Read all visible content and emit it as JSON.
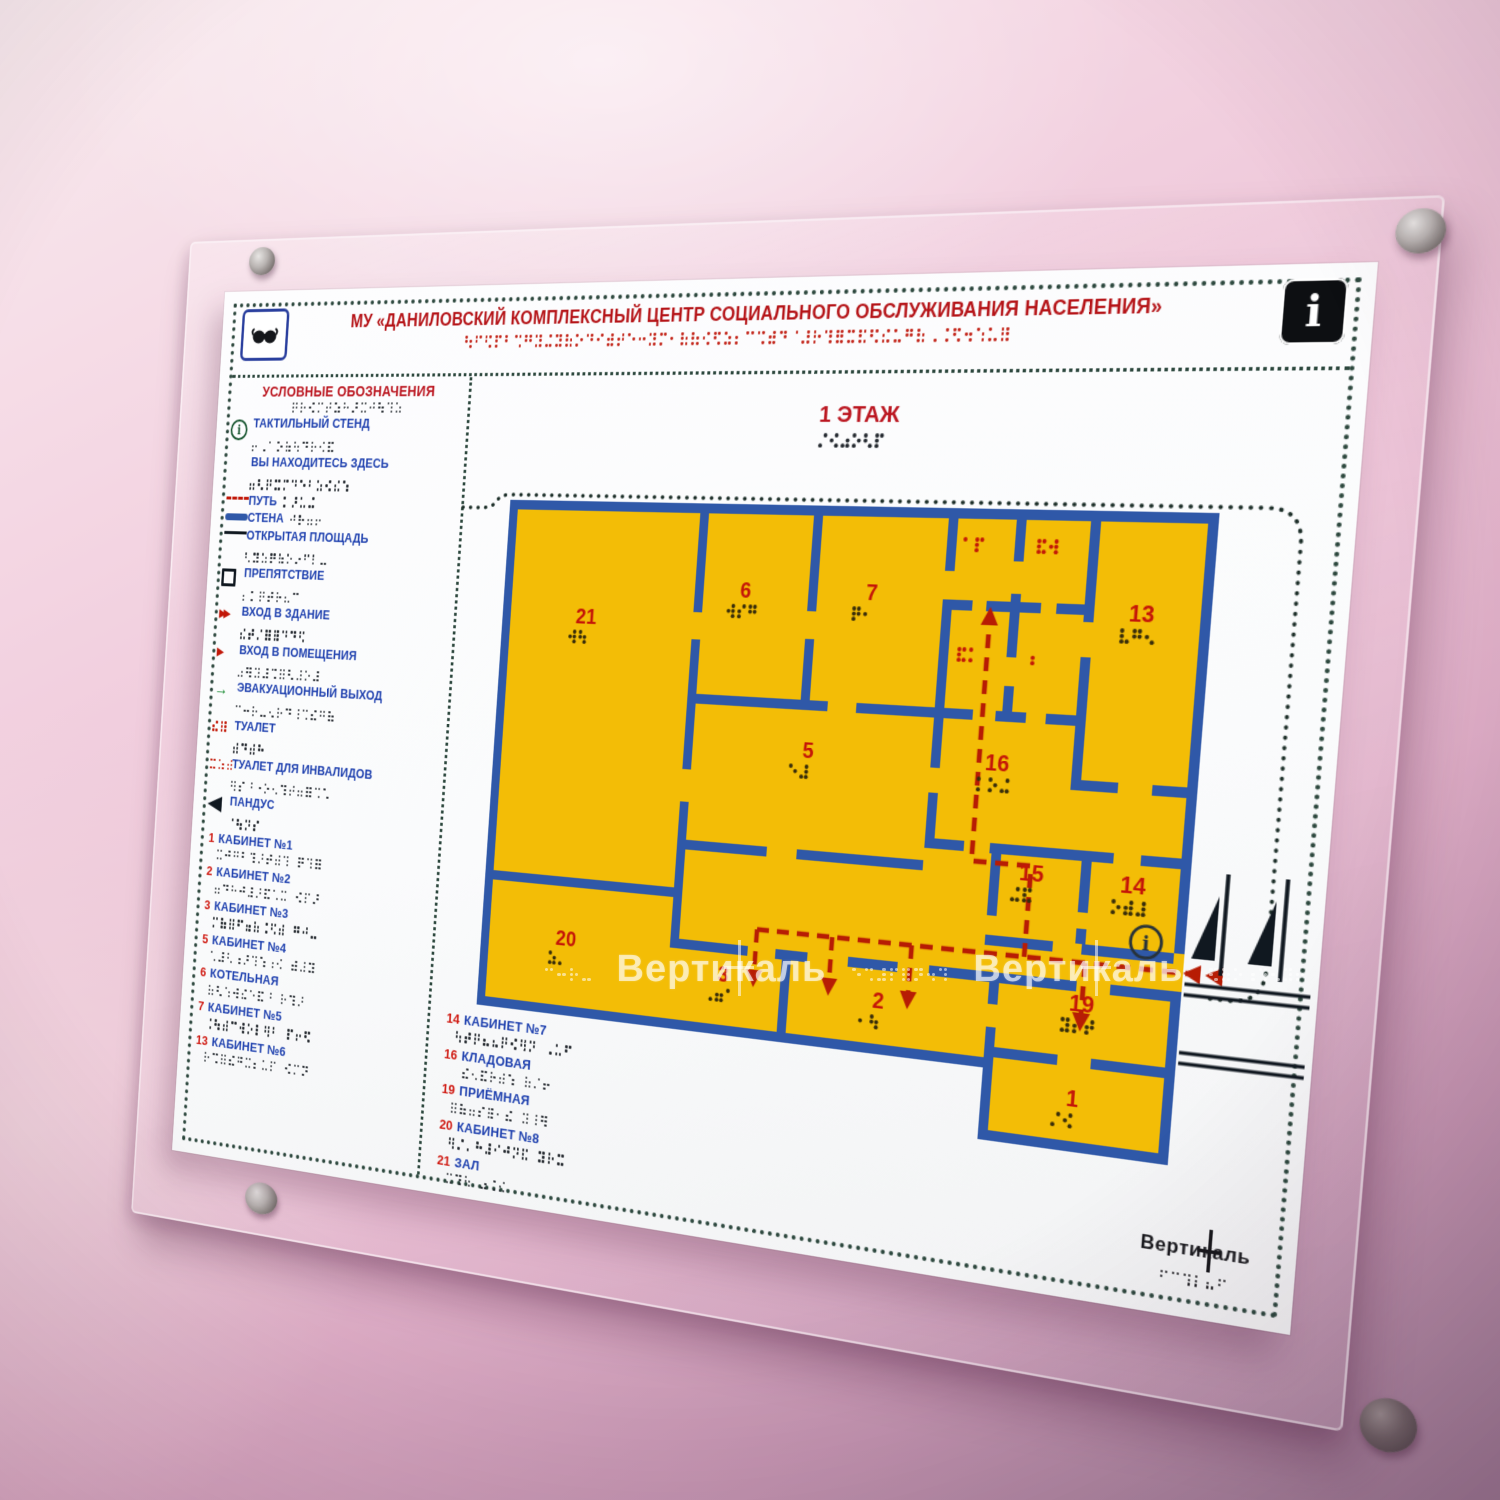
{
  "header": {
    "title": "МУ «ДАНИЛОВСКИЙ КОМПЛЕКСНЫЙ ЦЕНТР СОЦИАЛЬНОГО ОБСЛУЖИВАНИЯ НАСЕЛЕНИЯ»"
  },
  "icons": {
    "info_letter": "i"
  },
  "legend": {
    "heading": "УСЛОВНЫЕ ОБОЗНАЧЕНИЯ",
    "items": [
      {
        "icon": "info-circle",
        "label": "ТАКТИЛЬНЫЙ СТЕНД"
      },
      {
        "icon": "none",
        "label": "ВЫ НАХОДИТЕСЬ ЗДЕСЬ"
      },
      {
        "icon": "path-dashed",
        "label": "ПУТЬ",
        "inline": true
      },
      {
        "icon": "wall-bar",
        "label": "СТЕНА",
        "inline": true
      },
      {
        "icon": "thin-line",
        "label": "ОТКРЫТАЯ ПЛОЩАДЬ"
      },
      {
        "icon": "square-outline",
        "label": "ПРЕПЯТСТВИЕ"
      },
      {
        "icon": "double-arrow-red",
        "label": "ВХОД В ЗДАНИЕ"
      },
      {
        "icon": "arrow-red",
        "label": "ВХОД В ПОМЕЩЕНИЯ"
      },
      {
        "icon": "arrow-green",
        "label": "ЭВАКУАЦИОННЫЙ ВЫХОД"
      },
      {
        "icon": "braille-red",
        "label": "ТУАЛЕТ"
      },
      {
        "icon": "braille-red-wide",
        "label": "ТУАЛЕТ ДЛЯ ИНВАЛИДОВ"
      },
      {
        "icon": "ramp-triangle",
        "label": "ПАНДУС"
      }
    ]
  },
  "rooms_left": [
    {
      "num": "1",
      "name": "КАБИНЕТ №1"
    },
    {
      "num": "2",
      "name": "КАБИНЕТ №2"
    },
    {
      "num": "3",
      "name": "КАБИНЕТ №3"
    },
    {
      "num": "5",
      "name": "КАБИНЕТ №4"
    },
    {
      "num": "6",
      "name": "КОТЕЛЬНАЯ"
    },
    {
      "num": "7",
      "name": "КАБИНЕТ №5"
    },
    {
      "num": "13",
      "name": "КАБИНЕТ №6"
    }
  ],
  "rooms_middle": [
    {
      "num": "14",
      "name": "КАБИНЕТ №7"
    },
    {
      "num": "16",
      "name": "КЛАДОВАЯ"
    },
    {
      "num": "19",
      "name": "ПРИЁМНАЯ"
    },
    {
      "num": "20",
      "name": "КАБИНЕТ №8"
    },
    {
      "num": "21",
      "name": "ЗАЛ"
    }
  ],
  "plan": {
    "floor_label": "1 ЭТАЖ",
    "marker_label": "i",
    "room_labels": [
      {
        "n": "21",
        "x": 447,
        "y": 320
      },
      {
        "n": "6",
        "x": 612,
        "y": 290
      },
      {
        "n": "7",
        "x": 737,
        "y": 288
      },
      {
        "n": "13",
        "x": 986,
        "y": 298
      },
      {
        "n": "5",
        "x": 686,
        "y": 432
      },
      {
        "n": "16",
        "x": 867,
        "y": 432
      },
      {
        "n": "15",
        "x": 906,
        "y": 525
      },
      {
        "n": "14",
        "x": 997,
        "y": 528
      },
      {
        "n": "20",
        "x": 449,
        "y": 625
      },
      {
        "n": "3",
        "x": 617,
        "y": 642
      },
      {
        "n": "2",
        "x": 772,
        "y": 650
      },
      {
        "n": "19",
        "x": 960,
        "y": 633
      },
      {
        "n": "1",
        "x": 958,
        "y": 715
      }
    ],
    "toilet_markers": [
      [
        822,
        232
      ],
      [
        890,
        232
      ],
      [
        824,
        328
      ],
      [
        892,
        328
      ]
    ]
  },
  "watermark": {
    "text": "Вертикаль"
  },
  "logo": {
    "text": "Вертикаль"
  },
  "colors": {
    "title_red": "#b51418",
    "label_blue": "#1d3fae",
    "number_red": "#cf1810",
    "wall_blue": "#2f58a8",
    "room_yellow": "#f3bd06",
    "path_red": "#b71c04",
    "border_dots_green": "#2c473d",
    "plan_number_red": "#c41508",
    "plan_braille_dark": "#382d0a",
    "toilet_braille_red": "#c21807",
    "wall_pink": "#ecc0d5"
  }
}
